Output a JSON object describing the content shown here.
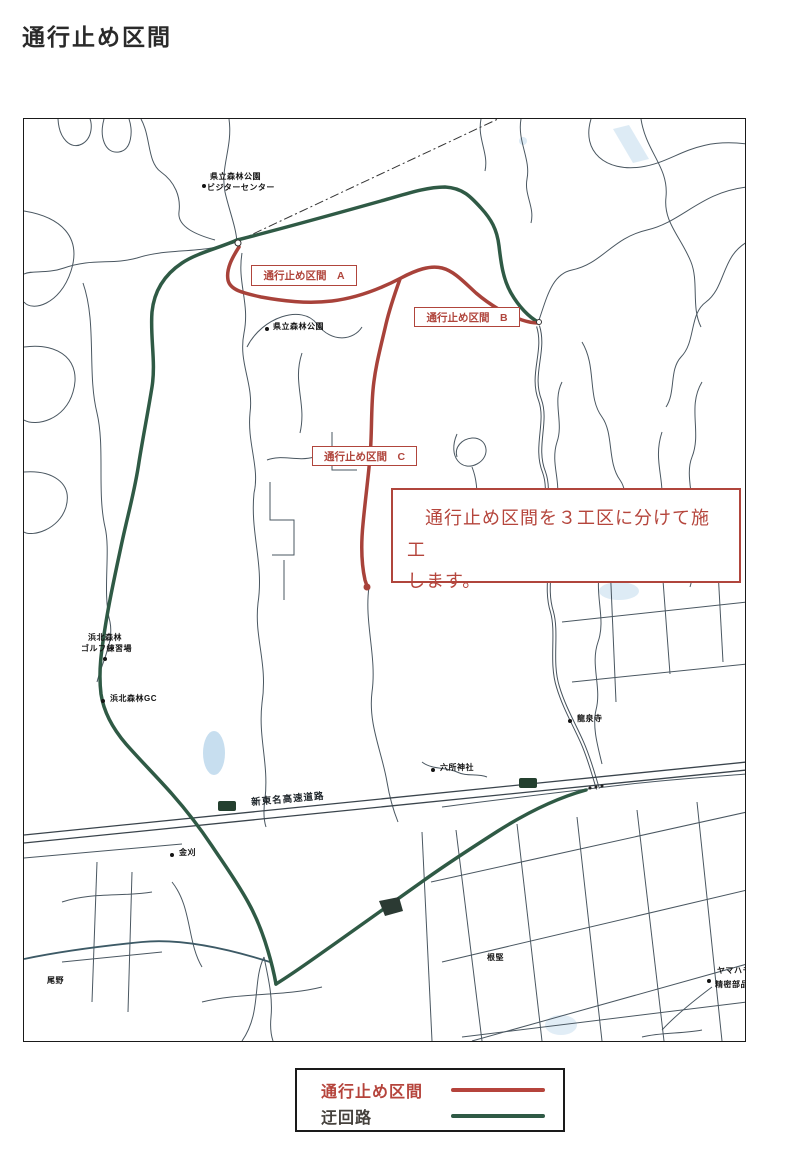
{
  "title": "通行止め区間",
  "colors": {
    "closure_red": "#b0453c",
    "detour_green": "#2f5a45",
    "road_gray": "#4a5761",
    "water_blue": "#a9cce6"
  },
  "map": {
    "closure_labels": [
      {
        "id": "A",
        "text": "通行止め区間　A"
      },
      {
        "id": "B",
        "text": "通行止め区間　B"
      },
      {
        "id": "C",
        "text": "通行止め区間　C"
      }
    ],
    "note": {
      "line1": "通行止め区間を３工区に分けて施工",
      "line2": "します。"
    },
    "pois": [
      {
        "text": "県立森林公園"
      },
      {
        "text": "ビジターセンター"
      },
      {
        "text": "県立森林公園"
      },
      {
        "text": "浜北森林"
      },
      {
        "text": "ゴルフ練習場"
      },
      {
        "text": "浜北森林GC"
      },
      {
        "text": "龍泉寺"
      },
      {
        "text": "六所神社"
      },
      {
        "text": "金刈"
      },
      {
        "text": "根堅"
      },
      {
        "text": "尾野"
      },
      {
        "text": "ヤマハモ"
      },
      {
        "text": "精密部品"
      }
    ],
    "expressway_label": "新東名高速道路"
  },
  "legend": {
    "items": [
      {
        "label": "通行止め区間",
        "color": "#b5443c"
      },
      {
        "label": "迂回路",
        "color": "#2f5a45"
      }
    ]
  }
}
